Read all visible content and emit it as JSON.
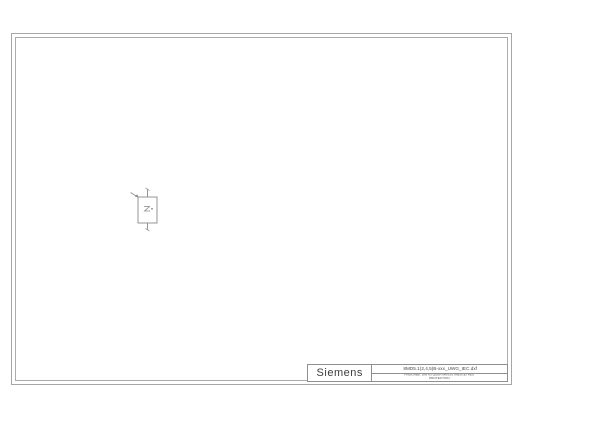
{
  "sheet": {
    "type": "cad-drawing-sheet",
    "frame_color": "#a6a6a6",
    "line_color": "#8a8a8a",
    "background": "#ffffff"
  },
  "title_block": {
    "brand": "Siemens",
    "filename": "8MD5.1(2,4,5)B-xxx_UWG_IEC.dxf",
    "note_line1": "FREIGABE: DIN A3 QUER MASSSTABSGETREU",
    "note_line2": "PROTECTION",
    "text_color": "#4a4a4a"
  },
  "icons": {
    "component_symbol": "disconnector-box-with-actuator-arrow"
  }
}
